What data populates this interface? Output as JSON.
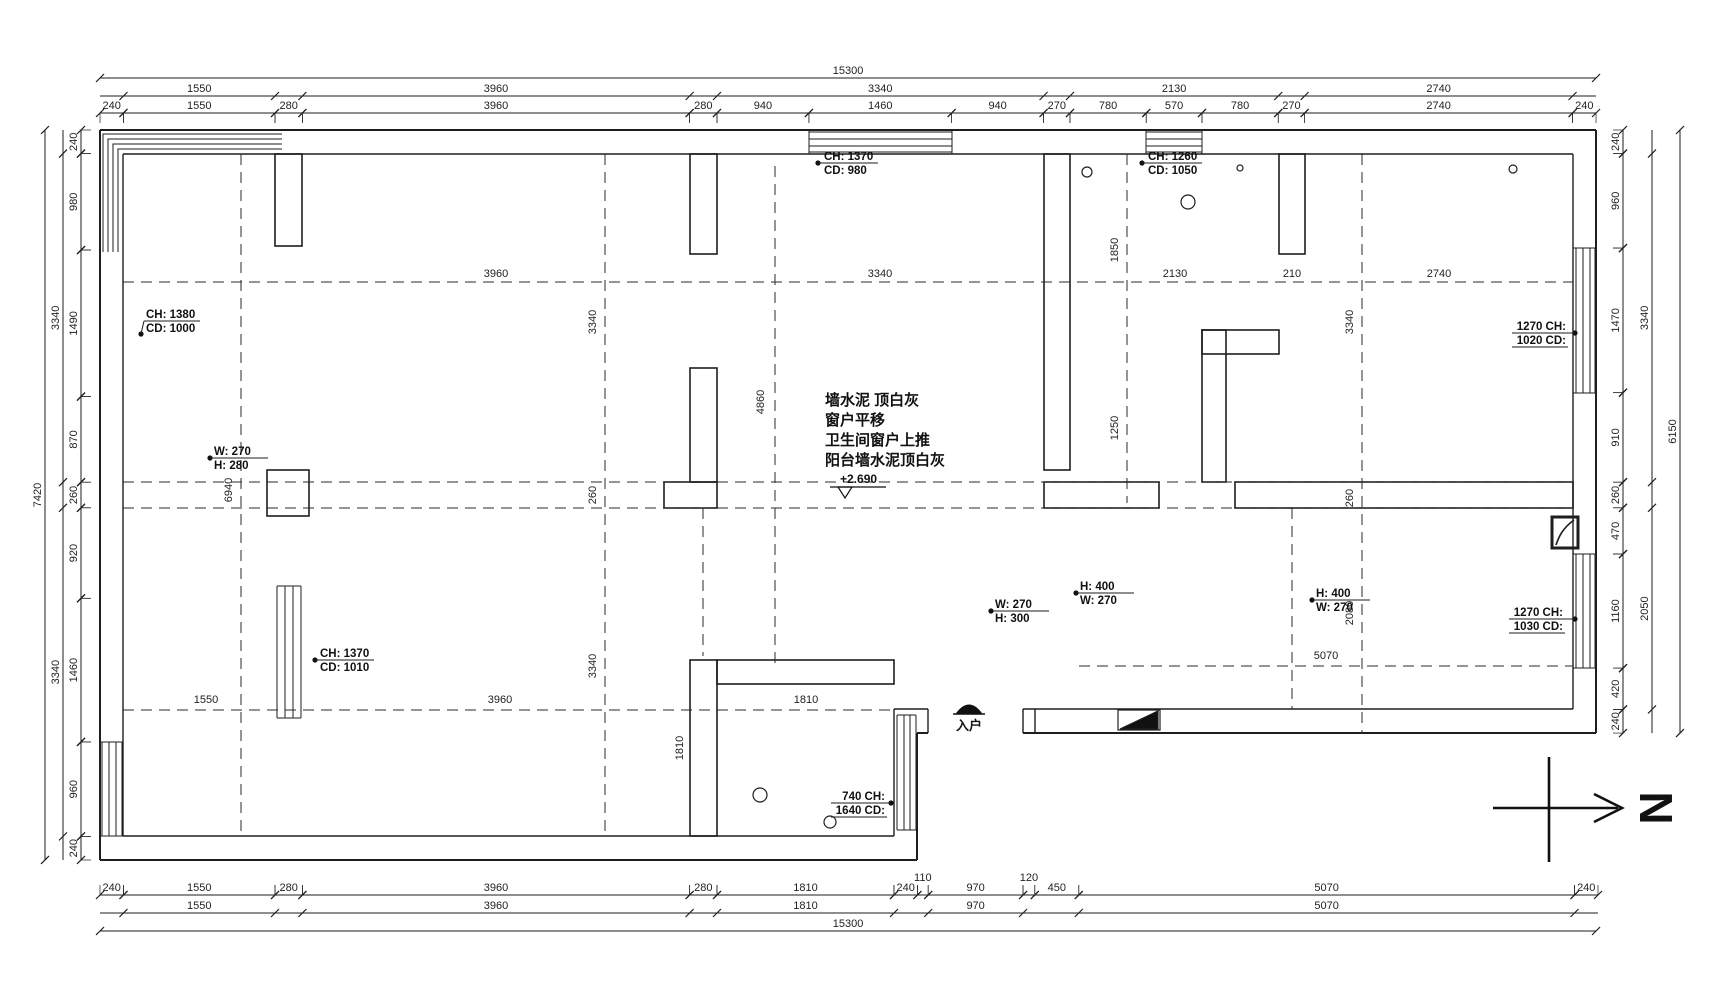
{
  "drawing": {
    "colors": {
      "line": "#1e1e1e",
      "dash": "#2a2a2a"
    },
    "notes": {
      "lines": [
        "墙水泥 顶白灰",
        "窗户平移",
        "卫生间窗户上推",
        "阳台墙水泥顶白灰"
      ],
      "level": "+2.690"
    },
    "entry": {
      "label": "入户"
    },
    "north": {
      "label": "N"
    },
    "dimension_chains": [
      {
        "name": "dim-top-overall",
        "dir": "h",
        "at": 78,
        "start": 100,
        "scale": 0.09778,
        "segments": [
          [
            15300,
            "15300"
          ]
        ]
      },
      {
        "name": "dim-top-major",
        "dir": "h",
        "at": 96,
        "start": 100,
        "scale": 0.09778,
        "segments": [
          [
            240,
            ""
          ],
          [
            1550,
            "1550"
          ],
          [
            280,
            ""
          ],
          [
            3960,
            "3960"
          ],
          [
            280,
            ""
          ],
          [
            3340,
            "3340"
          ],
          [
            270,
            ""
          ],
          [
            2130,
            "2130"
          ],
          [
            270,
            ""
          ],
          [
            2740,
            "2740"
          ],
          [
            240,
            ""
          ]
        ]
      },
      {
        "name": "dim-top-detail",
        "dir": "h",
        "at": 113,
        "start": 100,
        "scale": 0.09778,
        "ext": 10,
        "segments": [
          [
            240,
            "240"
          ],
          [
            1550,
            "1550"
          ],
          [
            280,
            "280"
          ],
          [
            3960,
            "3960"
          ],
          [
            280,
            "280"
          ],
          [
            940,
            "940"
          ],
          [
            1460,
            "1460"
          ],
          [
            940,
            "940"
          ],
          [
            270,
            "270"
          ],
          [
            780,
            "780"
          ],
          [
            570,
            "570"
          ],
          [
            780,
            "780"
          ],
          [
            270,
            "270"
          ],
          [
            2740,
            "2740"
          ],
          [
            240,
            "240"
          ]
        ]
      },
      {
        "name": "dim-bottom-detail",
        "dir": "h",
        "at": 895,
        "start": 100,
        "scale": 0.09778,
        "ext": -10,
        "segments": [
          [
            240,
            "240"
          ],
          [
            1550,
            "1550"
          ],
          [
            280,
            "280"
          ],
          [
            3960,
            "3960"
          ],
          [
            280,
            "280"
          ],
          [
            1810,
            "1810"
          ],
          [
            240,
            "240"
          ],
          [
            110,
            "110"
          ],
          [
            970,
            "970"
          ],
          [
            120,
            "120"
          ],
          [
            450,
            "450"
          ],
          [
            5070,
            "5070"
          ],
          [
            240,
            "240"
          ]
        ]
      },
      {
        "name": "dim-bottom-major",
        "dir": "h",
        "at": 913,
        "start": 100,
        "scale": 0.09778,
        "segments": [
          [
            240,
            ""
          ],
          [
            1550,
            "1550"
          ],
          [
            280,
            ""
          ],
          [
            3960,
            "3960"
          ],
          [
            280,
            ""
          ],
          [
            1810,
            "1810"
          ],
          [
            350,
            ""
          ],
          [
            970,
            "970"
          ],
          [
            570,
            ""
          ],
          [
            5070,
            "5070"
          ],
          [
            240,
            ""
          ]
        ]
      },
      {
        "name": "dim-bottom-overall",
        "dir": "h",
        "at": 931,
        "start": 100,
        "scale": 0.09778,
        "segments": [
          [
            15300,
            "15300"
          ]
        ]
      },
      {
        "name": "dim-left-overall",
        "dir": "v",
        "at": 45,
        "start": 130,
        "scale": 0.09838,
        "segments": [
          [
            7420,
            "7420"
          ]
        ]
      },
      {
        "name": "dim-left-major",
        "dir": "v",
        "at": 63,
        "start": 130,
        "scale": 0.09838,
        "segments": [
          [
            240,
            ""
          ],
          [
            3340,
            "3340"
          ],
          [
            260,
            ""
          ],
          [
            3340,
            "3340"
          ],
          [
            240,
            ""
          ]
        ]
      },
      {
        "name": "dim-left-detail",
        "dir": "v",
        "at": 81,
        "start": 130,
        "scale": 0.09838,
        "ext": 10,
        "segments": [
          [
            240,
            "240"
          ],
          [
            980,
            "980"
          ],
          [
            1490,
            "1490"
          ],
          [
            870,
            "870"
          ],
          [
            260,
            "260"
          ],
          [
            920,
            "920"
          ],
          [
            1460,
            "1460"
          ],
          [
            960,
            "960"
          ],
          [
            240,
            "240"
          ]
        ]
      },
      {
        "name": "dim-right-detail",
        "dir": "v",
        "at": 1623,
        "start": 130,
        "scale": 0.09838,
        "ext": -10,
        "segments": [
          [
            240,
            "240"
          ],
          [
            960,
            "960"
          ],
          [
            1470,
            "1470"
          ],
          [
            910,
            "910"
          ],
          [
            260,
            "260"
          ],
          [
            470,
            "470"
          ],
          [
            1160,
            "1160"
          ],
          [
            420,
            "420"
          ],
          [
            240,
            "240"
          ]
        ]
      },
      {
        "name": "dim-right-major",
        "dir": "v",
        "at": 1652,
        "start": 130,
        "scale": 0.09838,
        "segments": [
          [
            240,
            ""
          ],
          [
            3340,
            "3340"
          ],
          [
            260,
            ""
          ],
          [
            2050,
            "2050"
          ],
          [
            240,
            ""
          ]
        ]
      },
      {
        "name": "dim-right-overall",
        "dir": "v",
        "at": 1680,
        "start": 130,
        "scale": 0.09838,
        "segments": [
          [
            6130,
            "6150"
          ]
        ]
      }
    ],
    "interior_dims": [
      {
        "text": "3960",
        "x": 496,
        "y": 277,
        "rot": false
      },
      {
        "text": "3340",
        "x": 880,
        "y": 277,
        "rot": false
      },
      {
        "text": "2130",
        "x": 1175,
        "y": 277,
        "rot": false
      },
      {
        "text": "210",
        "x": 1292,
        "y": 277,
        "rot": false
      },
      {
        "text": "2740",
        "x": 1439,
        "y": 277,
        "rot": false
      },
      {
        "text": "5070",
        "x": 1326,
        "y": 659,
        "rot": false
      },
      {
        "text": "1550",
        "x": 206,
        "y": 703,
        "rot": false
      },
      {
        "text": "3960",
        "x": 500,
        "y": 703,
        "rot": false
      },
      {
        "text": "1810",
        "x": 806,
        "y": 703,
        "rot": false
      },
      {
        "text": "6940",
        "x": 232,
        "y": 490,
        "rot": true
      },
      {
        "text": "3340",
        "x": 596,
        "y": 322,
        "rot": true
      },
      {
        "text": "260",
        "x": 596,
        "y": 495,
        "rot": true
      },
      {
        "text": "3340",
        "x": 596,
        "y": 666,
        "rot": true
      },
      {
        "text": "4860",
        "x": 764,
        "y": 402,
        "rot": true
      },
      {
        "text": "1850",
        "x": 1118,
        "y": 250,
        "rot": true
      },
      {
        "text": "1250",
        "x": 1118,
        "y": 428,
        "rot": true
      },
      {
        "text": "3340",
        "x": 1353,
        "y": 322,
        "rot": true
      },
      {
        "text": "260",
        "x": 1353,
        "y": 498,
        "rot": true
      },
      {
        "text": "2080",
        "x": 1353,
        "y": 613,
        "rot": true
      },
      {
        "text": "1810",
        "x": 683,
        "y": 748,
        "rot": true
      }
    ],
    "opening_labels": [
      {
        "lines": [
          "CH: 1370",
          "CD: 980"
        ],
        "x": 824,
        "y": 160,
        "align": "start",
        "underline": "first",
        "dot": [
          818,
          163
        ]
      },
      {
        "lines": [
          "CH: 1260",
          "CD: 1050"
        ],
        "x": 1148,
        "y": 160,
        "align": "start",
        "underline": "first",
        "dot": [
          1142,
          163
        ]
      },
      {
        "lines": [
          "CH: 1380",
          "CD: 1000"
        ],
        "x": 146,
        "y": 318,
        "align": "start",
        "underline": "first",
        "dot": [
          141,
          334
        ]
      },
      {
        "lines": [
          "1270 CH:",
          "1020 CD:"
        ],
        "x": 1566,
        "y": 330,
        "align": "end",
        "underline": "both",
        "dot": [
          1575,
          333
        ]
      },
      {
        "lines": [
          "W: 270",
          "H: 280"
        ],
        "x": 214,
        "y": 455,
        "align": "start",
        "underline": "first",
        "dot": [
          210,
          458
        ]
      },
      {
        "lines": [
          "CH: 1370",
          "CD: 1010"
        ],
        "x": 320,
        "y": 657,
        "align": "start",
        "underline": "first",
        "dot": [
          315,
          660
        ]
      },
      {
        "lines": [
          "W: 270",
          "H: 300"
        ],
        "x": 995,
        "y": 608,
        "align": "start",
        "underline": "first",
        "dot": [
          991,
          611
        ]
      },
      {
        "lines": [
          "H: 400",
          "W: 270"
        ],
        "x": 1080,
        "y": 590,
        "align": "start",
        "underline": "first",
        "dot": [
          1076,
          593
        ]
      },
      {
        "lines": [
          "H: 400",
          "W: 270"
        ],
        "x": 1316,
        "y": 597,
        "align": "start",
        "underline": "first",
        "dot": [
          1312,
          600
        ]
      },
      {
        "lines": [
          "1270 CH:",
          "1030 CD:"
        ],
        "x": 1563,
        "y": 616,
        "align": "end",
        "underline": "both",
        "dot": [
          1575,
          619
        ]
      },
      {
        "lines": [
          "740 CH:",
          "1640 CD:"
        ],
        "x": 885,
        "y": 800,
        "align": "end",
        "underline": "both",
        "dot": [
          891,
          803
        ]
      }
    ]
  }
}
